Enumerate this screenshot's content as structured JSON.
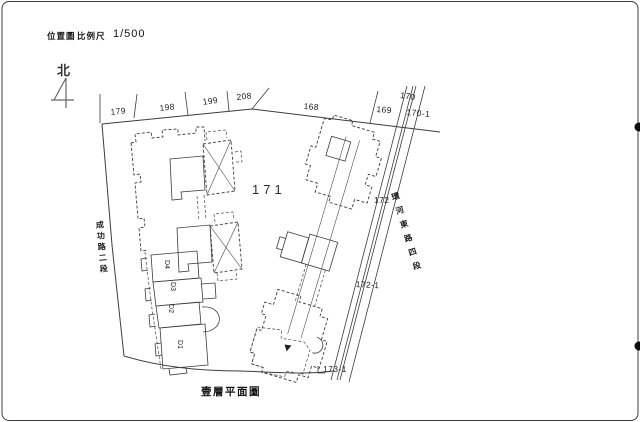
{
  "title_block": {
    "map_label": "位置圖",
    "scale_label": "比例尺",
    "scale_value": "1/500"
  },
  "north_label": "北",
  "roads": {
    "west": "成功路二段",
    "east": "環河東路四段"
  },
  "lots": {
    "n179": "179",
    "n198": "198",
    "n199": "199",
    "n208": "208",
    "n168": "168",
    "n169": "169",
    "n170": "170",
    "n170_1": "170-1",
    "n171": "171",
    "n172": "172",
    "n172_1": "172-1",
    "n173_1": "173-1"
  },
  "units": {
    "d1": "D1",
    "d2": "D2",
    "d3": "D3",
    "d4": "D4"
  },
  "caption": "壹層平面圖",
  "colors": {
    "line": "#3c3c3c",
    "text": "#141414",
    "paper": "#ffffff",
    "border": "#8a8a8a"
  }
}
